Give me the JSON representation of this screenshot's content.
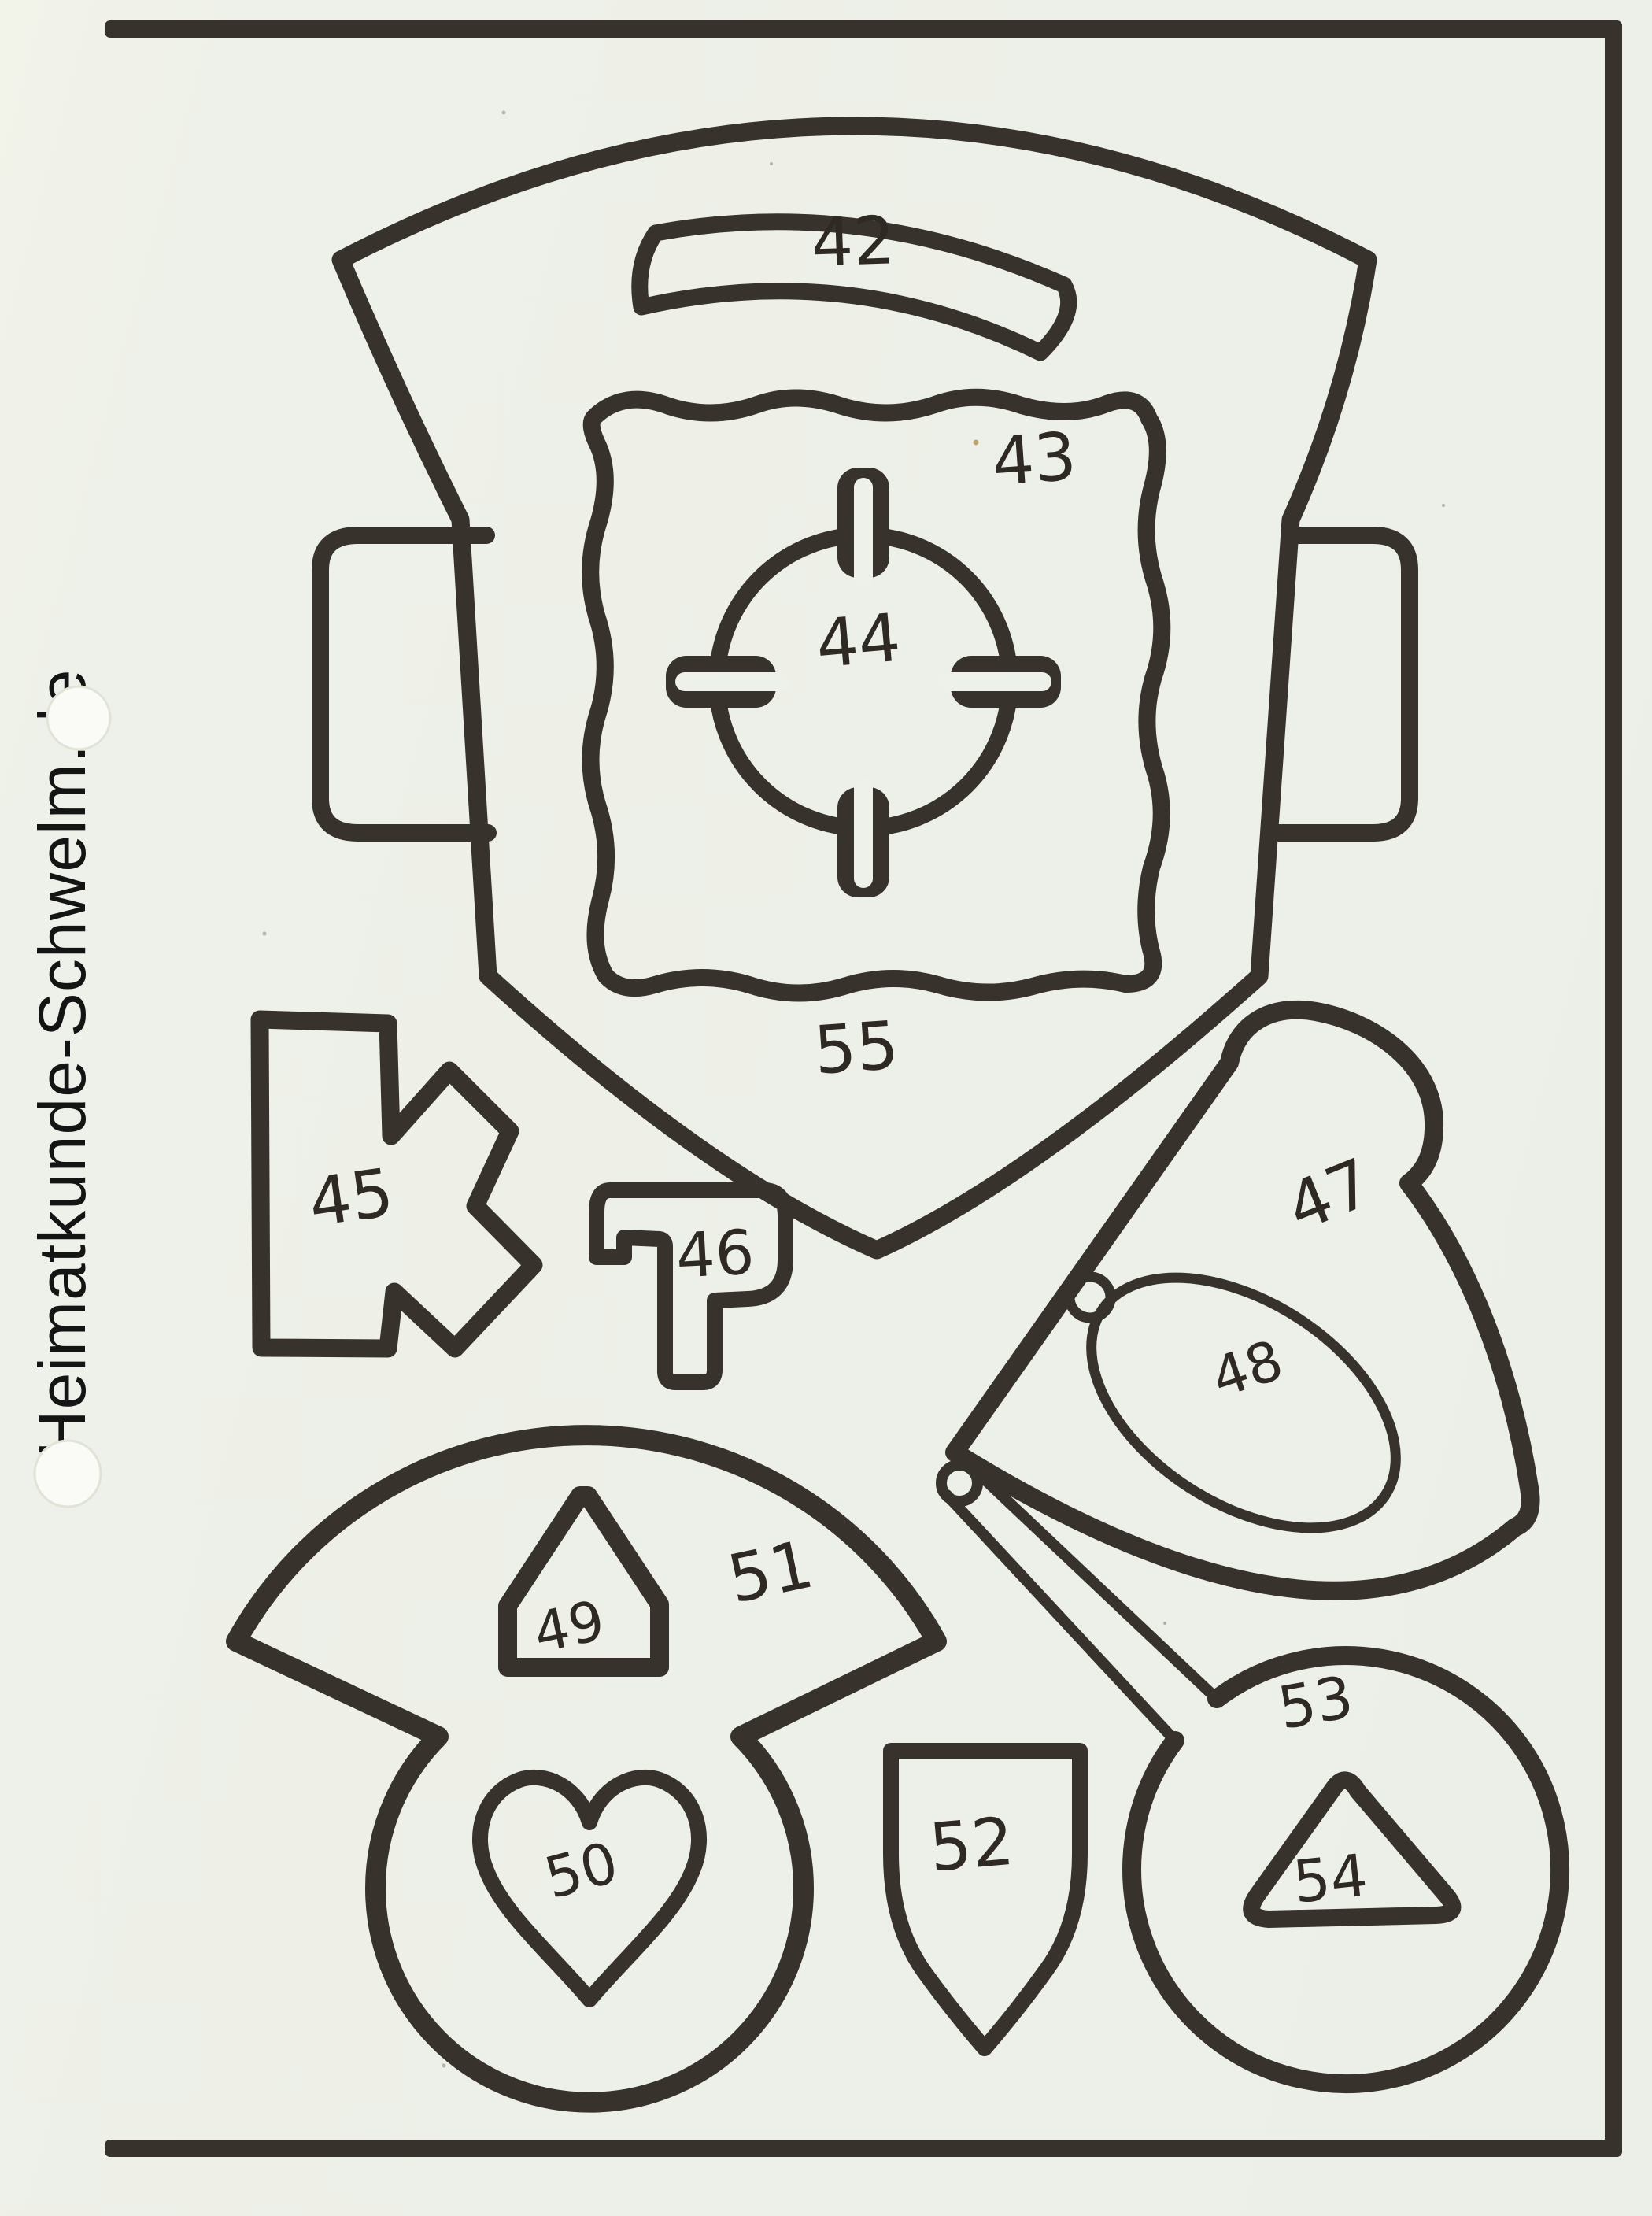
{
  "page": {
    "kind": "scanned fretwork template sheet",
    "paper_color": "#eef1e9",
    "ink_color": "#37332c",
    "watermark_color": "#141414"
  },
  "watermark": {
    "text": "Heimatkunde-Schwelm.de"
  },
  "parts": [
    {
      "label": "42",
      "shape": "curved-slot-bar"
    },
    {
      "label": "43",
      "shape": "scalloped-square-plate"
    },
    {
      "label": "44",
      "shape": "ring-with-four-key-stubs"
    },
    {
      "label": "45",
      "shape": "k-bracket"
    },
    {
      "label": "46",
      "shape": "flag-bracket"
    },
    {
      "label": "47",
      "shape": "curved-wing"
    },
    {
      "label": "48",
      "shape": "oval-with-knob"
    },
    {
      "label": "49",
      "shape": "house-pentagon"
    },
    {
      "label": "50",
      "shape": "heart"
    },
    {
      "label": "51",
      "shape": "fan-with-circle-body"
    },
    {
      "label": "52",
      "shape": "small-shield"
    },
    {
      "label": "53",
      "shape": "circle-with-stick"
    },
    {
      "label": "54",
      "shape": "rounded-triangle"
    },
    {
      "label": "55",
      "shape": "large-shield-with-side-tabs"
    }
  ]
}
